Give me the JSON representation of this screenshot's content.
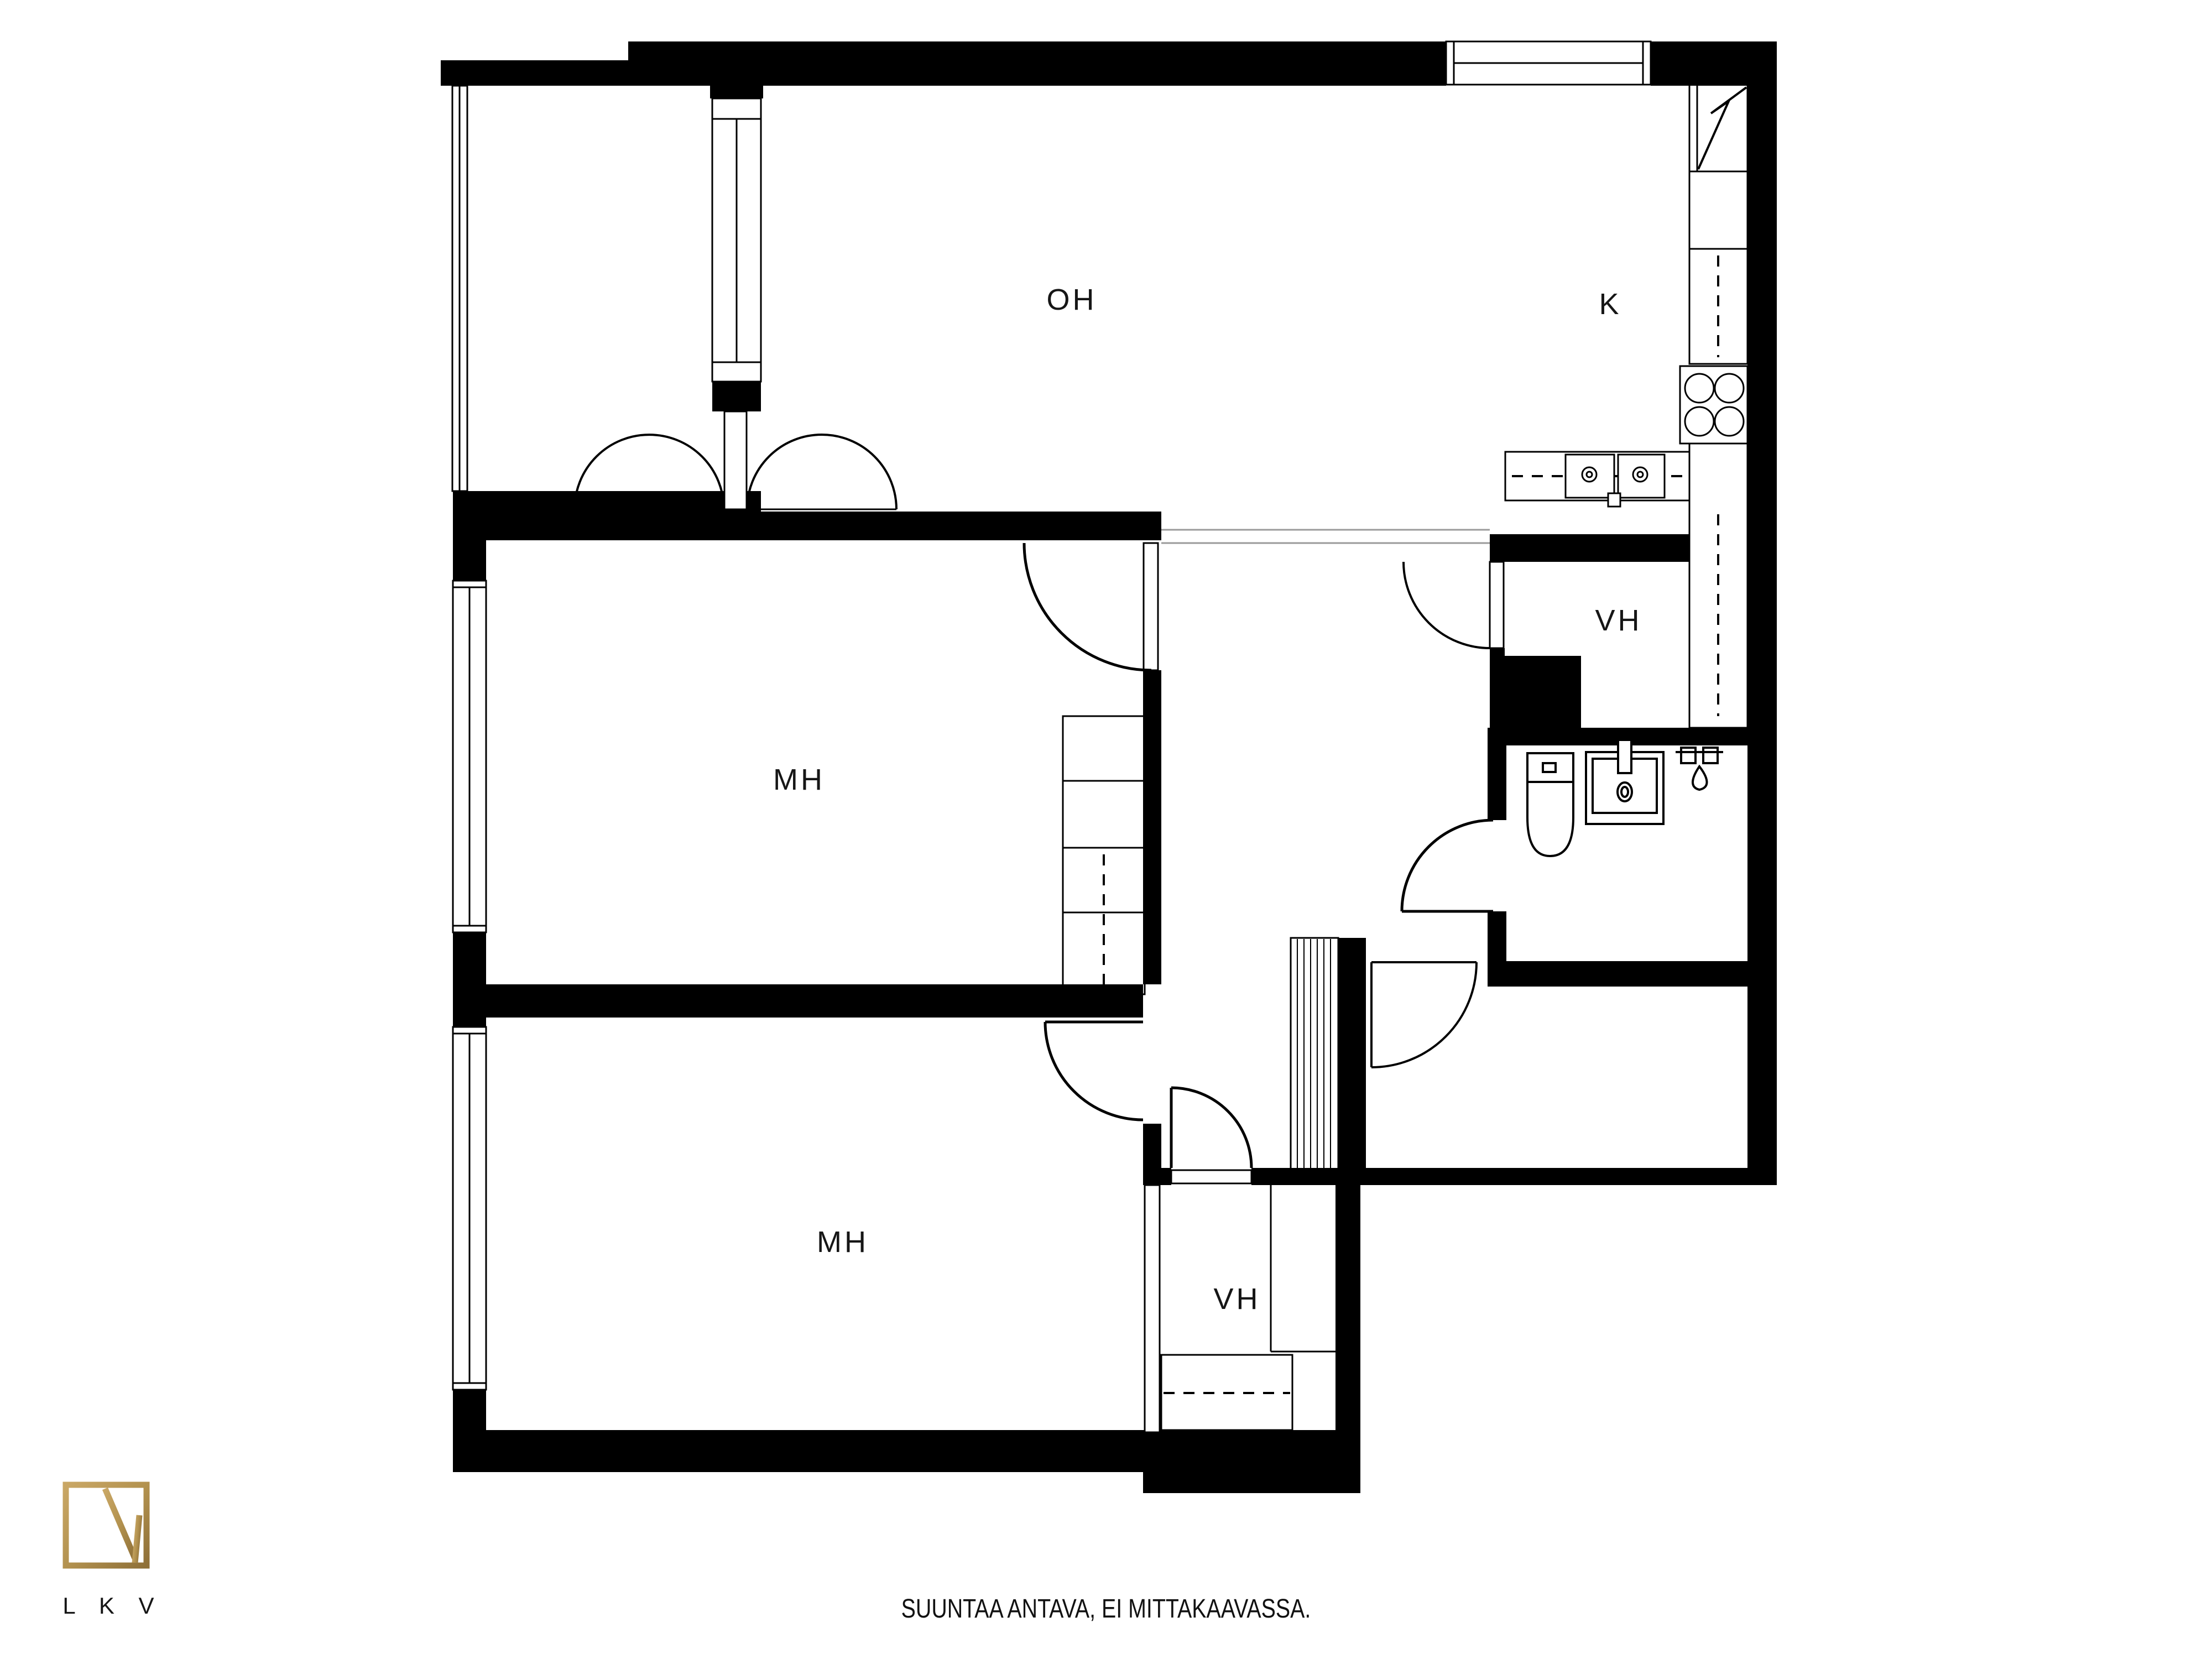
{
  "page": {
    "background": "#ffffff",
    "wall_color": "#000000",
    "line_color": "#111111"
  },
  "plan": {
    "type": "apartment-floor-plan",
    "rooms": [
      {
        "id": "oh",
        "label": "OH"
      },
      {
        "id": "k",
        "label": "K"
      },
      {
        "id": "mh1",
        "label": "MH"
      },
      {
        "id": "mh2",
        "label": "MH"
      },
      {
        "id": "vh1",
        "label": "VH"
      },
      {
        "id": "vh2",
        "label": "VH"
      }
    ],
    "fixtures": [
      "fridge-freezer-icon",
      "kitchen-double-sink-icon",
      "stove-4-burner-icon",
      "toilet-icon",
      "washbasin-icon",
      "shower-tap-icon",
      "wardrobe-icon",
      "ventilation-shaft-icon",
      "window-icon",
      "door-swing-icon"
    ]
  },
  "footer": {
    "disclaimer": "SUUNTAA ANTAVA, EI MITTAKAAVASSA."
  },
  "logo": {
    "text": "L K V",
    "color": "#b3924f"
  }
}
